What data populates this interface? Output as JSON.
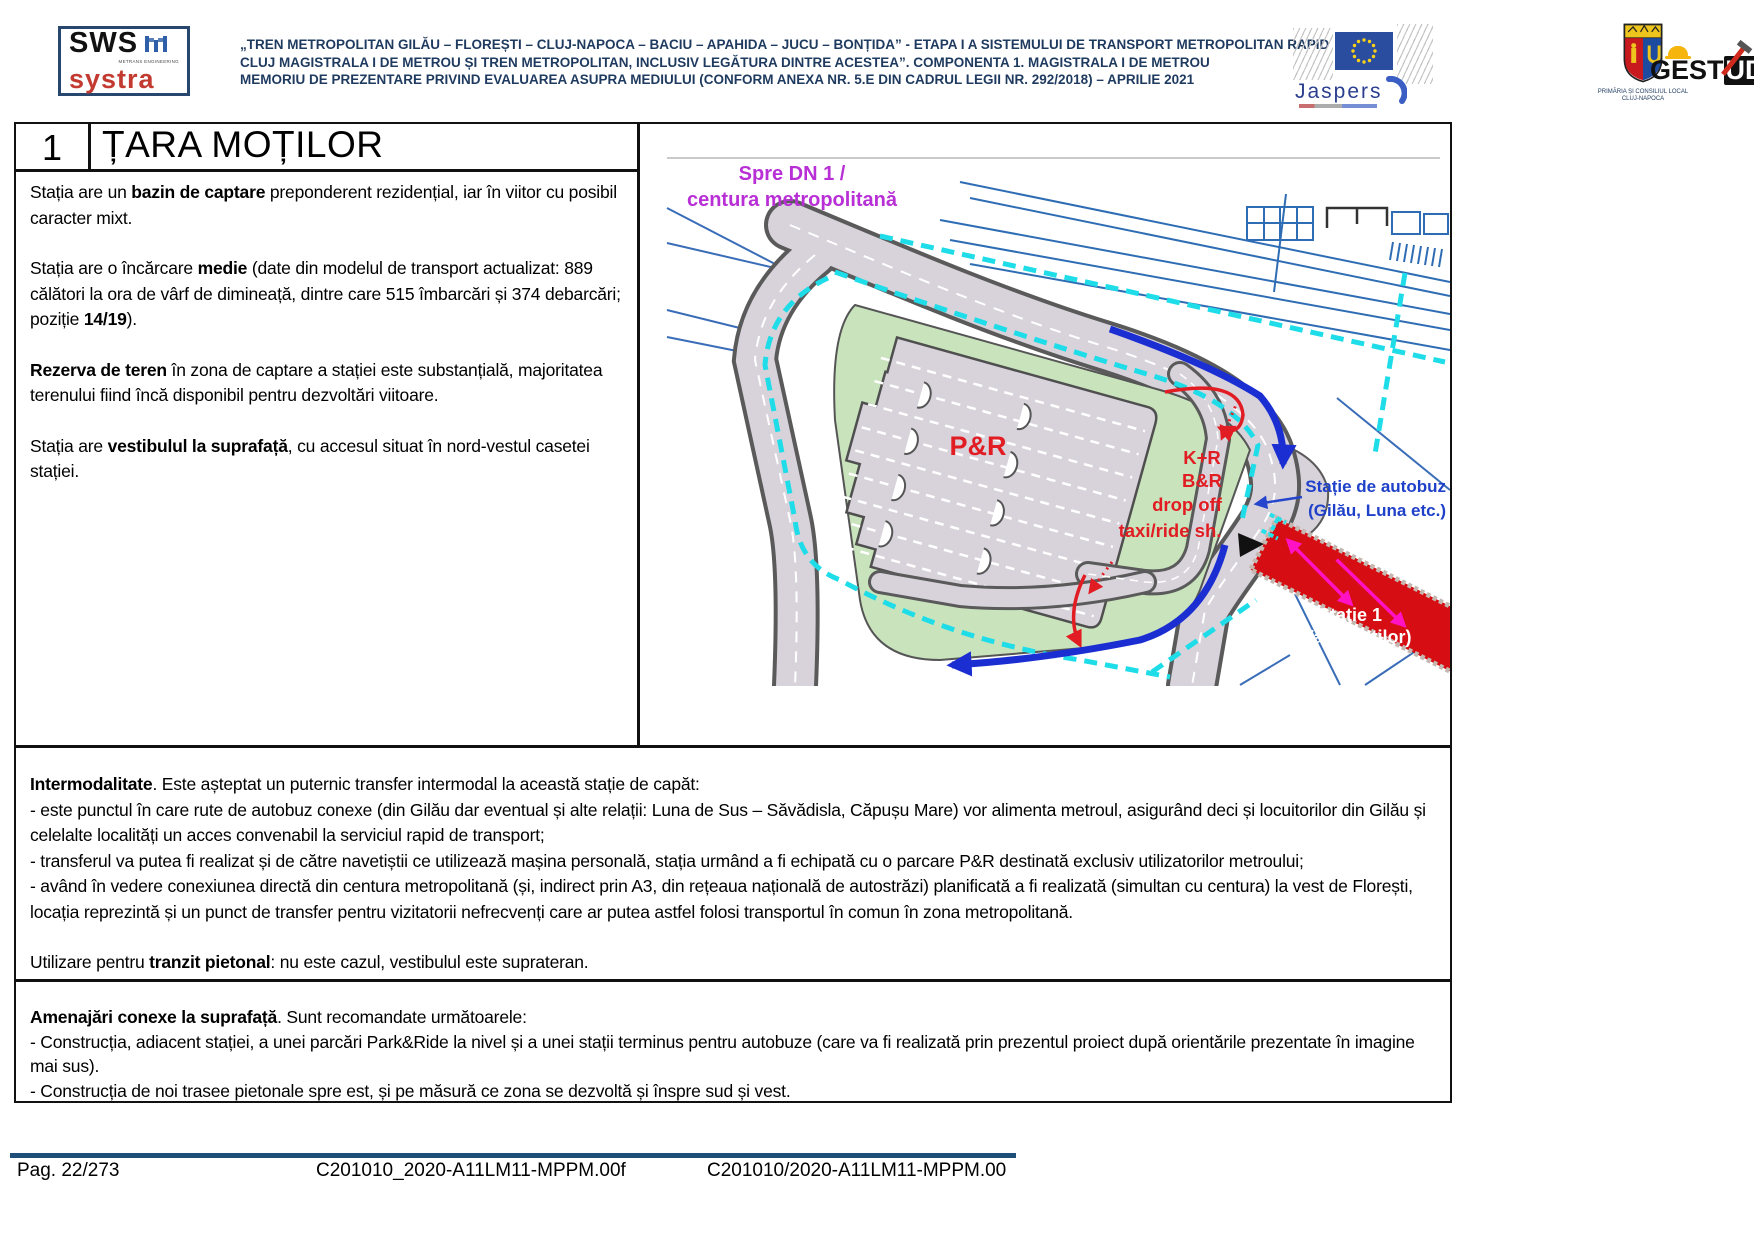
{
  "header": {
    "logo_sws": "SWS",
    "logo_sws_sub": "METRANS ENGINEERING",
    "logo_systra": "systra",
    "title_lines": [
      "„TREN METROPOLITAN GILĂU – FLOREȘTI – CLUJ-NAPOCA – BACIU – APAHIDA – JUCU – BONȚIDA” - ETAPA I A SISTEMULUI DE TRANSPORT METROPOLITAN RAPID",
      "CLUJ MAGISTRALA I DE METROU ȘI TREN METROPOLITAN, INCLUSIV LEGĂTURA DINTRE ACESTEA”. COMPONENTA 1. MAGISTRALA I DE METROU",
      "MEMORIU DE PREZENTARE PRIVIND EVALUAREA ASUPRA MEDIULUI (CONFORM ANEXA NR. 5.E DIN CADRUL LEGII NR. 292/2018) – APRILIE 2021"
    ],
    "jaspers": "Jaspers",
    "cityhall_line1": "PRIMĂRIA ȘI CONSILIUL LOCAL",
    "cityhall_line2": "CLUJ-NAPOCA",
    "geostud_ge": "GE",
    "geostud_st": "ST",
    "geostud_ud": "UD"
  },
  "station": {
    "number": "1",
    "name": "ȚARA MOȚILOR"
  },
  "left_panel": {
    "p1": [
      {
        "t": "Stația are un "
      },
      {
        "t": "bazin de captare",
        "b": true
      },
      {
        "t": " preponderent rezidențial, iar în viitor cu posibil caracter mixt."
      }
    ],
    "p2": [
      {
        "t": "Stația are o încărcare "
      },
      {
        "t": "medie",
        "b": true
      },
      {
        "t": " (date din modelul de transport actualizat: 889 călători la ora de vârf de dimineață, dintre care 515 îmbarcări și 374 debarcări; poziție "
      },
      {
        "t": "14/19",
        "b": true
      },
      {
        "t": ")."
      }
    ],
    "p3": [
      {
        "t": "Rezerva de teren",
        "b": true
      },
      {
        "t": " în zona de captare a stației este substanțială, majoritatea terenului fiind încă disponibil pentru dezvoltări viitoare."
      }
    ],
    "p4": [
      {
        "t": "Stația are "
      },
      {
        "t": "vestibulul la suprafață",
        "b": true
      },
      {
        "t": ", cu accesul situat în nord-vestul casetei stației."
      }
    ]
  },
  "map": {
    "labels": {
      "dn1_line1": "Spre DN 1 /",
      "dn1_line2": "centura metropolitană",
      "pr": "P&R",
      "kr": "K+R",
      "br": "B&R",
      "dropoff": "drop off",
      "taxi": "taxi/ride sh.",
      "bus_line1": "Stație de autobuz",
      "bus_line2": "(Gilău, Luna etc.)",
      "station_line1": "Stație 1",
      "station_line2": "(Țara Moților)"
    }
  },
  "intermodality": {
    "heading": [
      {
        "t": "Intermodalitate",
        "b": true
      },
      {
        "t": ". Este așteptat un puternic transfer intermodal la această stație de capăt:"
      }
    ],
    "bullet1": [
      {
        "t": "- este punctul în care rute de autobuz conexe (din Gilău dar eventual și alte relații: Luna de Sus – Săvădisla, Căpușu Mare) vor alimenta metroul, asigurând deci și locuitorilor din Gilău și celelalte localități un acces convenabil la serviciul rapid de transport;"
      }
    ],
    "bullet2": [
      {
        "t": "- transferul va putea fi realizat și de către navetiștii ce utilizează mașina personală, stația urmând a fi echipată cu o parcare P&R destinată exclusiv utilizatorilor metroului;"
      }
    ],
    "bullet3": [
      {
        "t": "- având în vedere conexiunea directă din centura metropolitană (și, indirect prin A3, din rețeaua națională de autostrăzi) planificată a fi realizată (simultan cu centura) la vest de Florești, locația reprezintă și un punct de transfer pentru vizitatorii nefrecvenți care ar putea astfel folosi transportul în comun în zona metropolitană."
      }
    ],
    "transit": [
      {
        "t": "Utilizare pentru "
      },
      {
        "t": "tranzit pietonal",
        "b": true
      },
      {
        "t": ": nu este cazul, vestibulul este suprateran."
      }
    ]
  },
  "amenities": {
    "heading": [
      {
        "t": "Amenajări conexe la suprafață",
        "b": true
      },
      {
        "t": ". Sunt recomandate următoarele:"
      }
    ],
    "bullet1": [
      {
        "t": "- Construcția, adiacent stației, a unei parcări Park&Ride la nivel și a unei stații terminus pentru autobuze (care va fi realizată prin prezentul proiect după orientările prezentate în imagine mai sus)."
      }
    ],
    "bullet2": [
      {
        "t": "- Construcția de noi trasee pietonale spre est, și pe măsură ce zona se dezvoltă și înspre sud și vest."
      }
    ]
  },
  "footer": {
    "page": "Pag. 22/273",
    "ref1": "C201010_2020-A11LM11-MPPM.00f",
    "ref2": "C201010/2020-A11LM11-MPPM.00"
  },
  "colors": {
    "accent_navy": "#1e3a5f",
    "footer_bar": "#1f4e79",
    "systra_red": "#c23a30",
    "map_road": "#d8d3db",
    "map_green": "#c9e4bd",
    "station_red": "#d60d12",
    "boundary_cyan": "#1fdde8",
    "label_magenta": "#b82fd6",
    "label_blue": "#1f41c9",
    "label_red": "#e11d23"
  }
}
